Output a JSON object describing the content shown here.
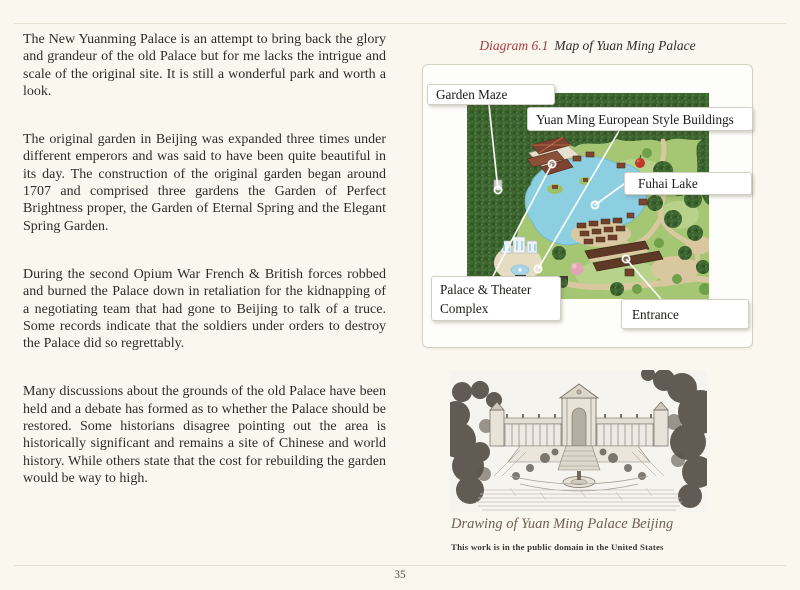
{
  "page": {
    "number": "35"
  },
  "article": {
    "paragraphs": [
      "The New Yuanming Palace is an attempt to bring back the glory and grandeur of the old Palace but for me lacks the intrigue and scale of the original site. It is still a wonderful park and worth a look.",
      "The original garden in Beijing was expanded three times under different emperors and was said to have been quite beautiful in its day. The construction of the original garden began around 1707 and comprised three gardens the Garden of Perfect Brightness proper, the Garden of Eternal Spring and the Elegant Spring Garden.",
      "During the second Opium War French & British forces robbed and burned the Palace down in retaliation for the kidnapping of a negotiating team that had gone to Beijing to talk of a truce. Some records indicate that the soldiers under orders to destroy the Palace did so regrettably.",
      "Many discussions about the grounds of the old Palace have been held and a debate has formed as to whether the Palace should be restored. Some historians disagree pointing out the area is historically significant and remains a site of Chinese and world history. While others state that the cost for rebuilding the garden would be way to high."
    ]
  },
  "diagram": {
    "number_label": "Diagram 6.1",
    "title": "Map of Yuan Ming Palace",
    "callouts": [
      {
        "text": "Garden Maze"
      },
      {
        "text": "Yuan Ming European Style Buildings"
      },
      {
        "text": "Fuhai Lake"
      },
      {
        "text": "Palace & Theater Complex"
      },
      {
        "text": "Entrance"
      }
    ]
  },
  "figure": {
    "caption": "Drawing of Yuan Ming Palace Beijing",
    "license": "This work is in the public domain in the United States"
  },
  "colors": {
    "page_background": "#FAF7EF",
    "body_text": "#2F2C28",
    "diagram_accent_red": "#A43E3E",
    "figure_caption": "#6F6052",
    "map_forest_green": "#3B622E",
    "map_grass_green": "#A5C673",
    "map_lake_blue": "#8CCFE1",
    "map_path_tan": "#D9C7A0",
    "map_roof_brown": "#7B4330"
  }
}
